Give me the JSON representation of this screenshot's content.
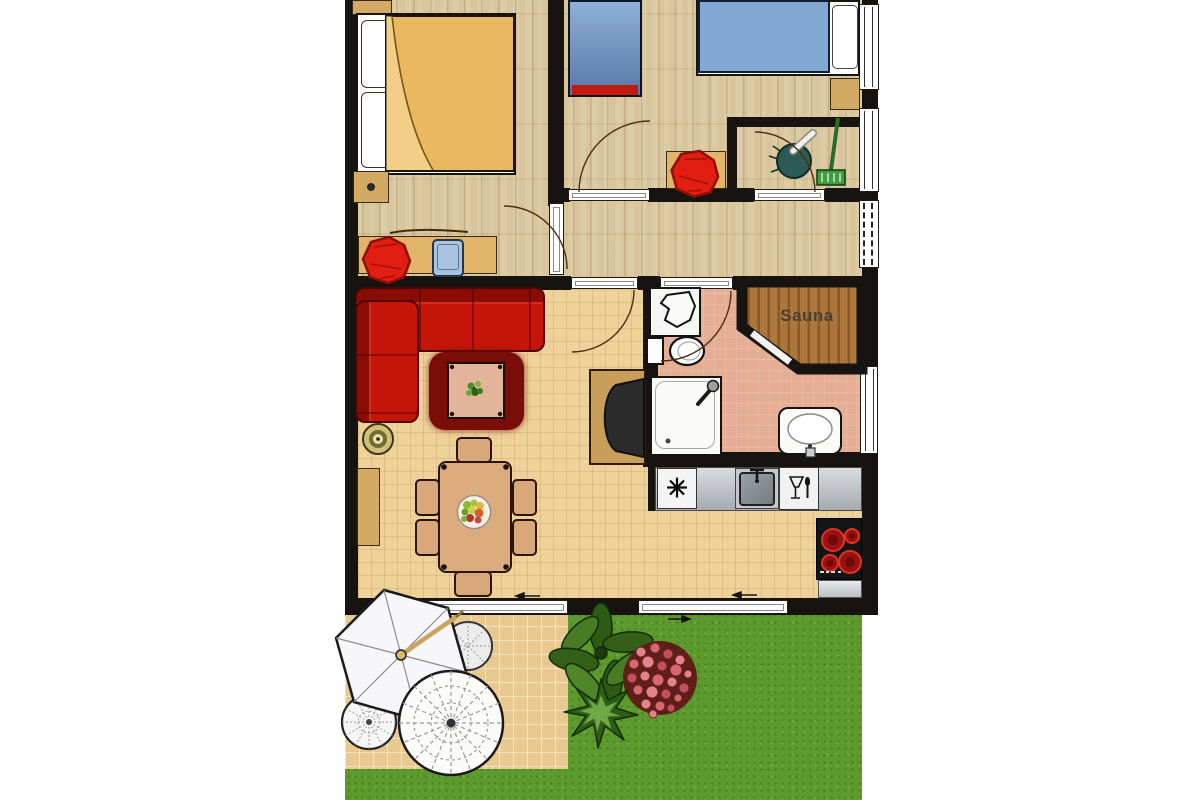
{
  "labels": {
    "sauna": "Sauna"
  },
  "icons": {
    "freezer": "✳",
    "dishwasher": "wine-glass-and-spoon-icon",
    "sink": "basin-with-faucet-icon",
    "stove": "four-burner-cooktop-icon"
  },
  "colors": {
    "wall": "#171310",
    "wood_floor": "#d8c59b",
    "tile_floor": "#eed29a",
    "bathroom_floor": "#e5ad93",
    "sauna_wood": "#ab773c",
    "grass": "#5c9a2e",
    "patio": "#e9c992",
    "sofa_red": "#c41508",
    "rug_red": "#7a0d07",
    "bed_duvet_yellow": "#eab85e",
    "bed_duvet_blue": "#82a8d4",
    "chair_red": "#e21d12",
    "furniture_tan": "#d3a964",
    "counter_steel": "#c7cbd0",
    "burner_red": "#991111",
    "umbrella_white": "#f7f7f9"
  }
}
